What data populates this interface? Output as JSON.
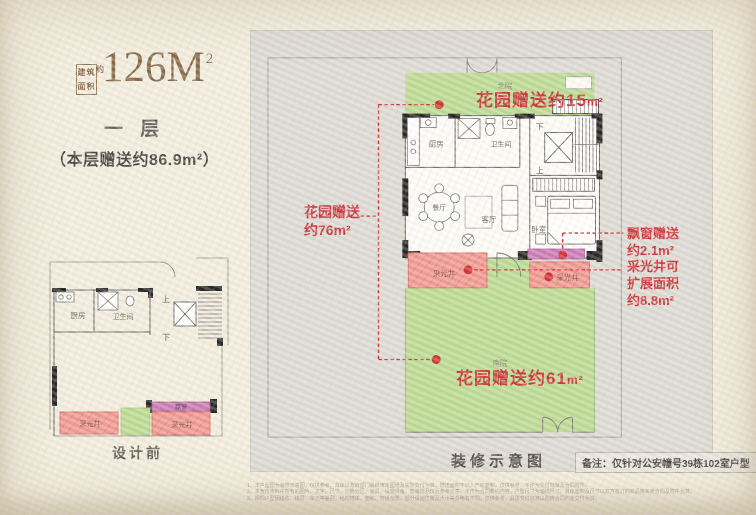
{
  "header": {
    "area_box": {
      "row1": "建筑",
      "row2": "面积",
      "approx": "约"
    },
    "area_value": "126M",
    "area_sup": "2",
    "floor_label": "一 层",
    "gift_label": "（本层赠送约86.9m²）"
  },
  "colors": {
    "background": "#f1ecdd",
    "panel_gray": "#dad8d3",
    "garden_green": "#b6d88c",
    "light_well_pink": "#f0938c",
    "bay_window_magenta": "#c770b2",
    "annotation_red": "#c8232c",
    "title_brown": "#7b5c39"
  },
  "before_plan": {
    "caption": "设计前",
    "labels": {
      "kitchen": "厨房",
      "bathroom": "卫生间",
      "up": "上",
      "down": "下",
      "bay_window": "飘窗",
      "light_well_left": "采光井",
      "light_well_right": "采光井"
    }
  },
  "main_plan": {
    "caption": "装修示意图",
    "note": "备注：仅针对公安幢号39栋102室户型",
    "labels": {
      "north_yard": "北院",
      "south_yard": "南院",
      "kitchen": "厨房",
      "bathroom": "卫生间",
      "down": "下",
      "up": "上",
      "dining": "餐厅",
      "living": "客厅",
      "bedroom": "卧室",
      "light_well_left": "采光井",
      "light_well_right": "采光井"
    },
    "annotations": {
      "garden_north": "花园赠送约15",
      "garden_north_unit": "m²",
      "garden_west_line1": "花园赠送",
      "garden_west_line2": "约76m²",
      "bay_line1": "飘窗赠送",
      "bay_line2": "约2.1m²",
      "well_line1": "采光井可",
      "well_line2": "扩展面积",
      "well_line3": "约8.8m²",
      "garden_south": "花园赠送约61",
      "garden_south_unit": "m²"
    }
  },
  "footnotes": {
    "line1": "1、本户型图为装修示意图，仅供参考，具体以政府部门最终审定图纸及实际交付为准，赠送面积不计入产权面积，仅供参考，不作为交付标准及合同附件。",
    "line2": "2、本宣传资料中所有的图片、文字、尺寸、功能分区、家具、设施设备、软装饰品仅为参考示意，不作为合同要约内容，户型尺寸为轴线尺寸，具体面积及尺寸以双方签订的商品房买卖合同及附件为准。",
    "line3": "3、相同户型因楼栋、楼层、单元等差别，结构墙体、面积、管道布置、部分设施位置及大小等会略有不同，仅供参考，具体交付标准以购房合同约定交付为准。"
  }
}
